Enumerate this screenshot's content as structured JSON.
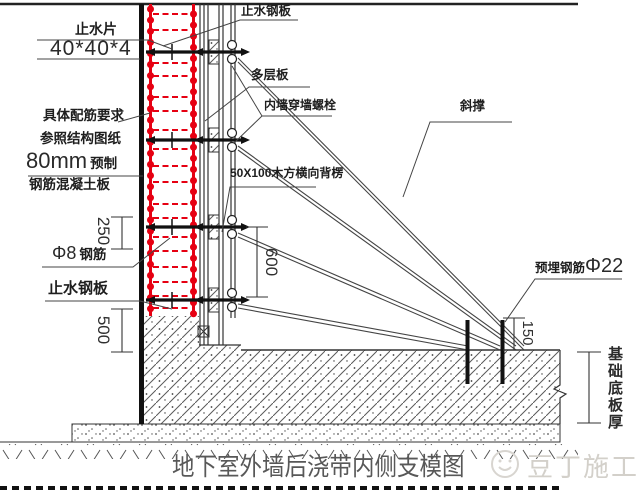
{
  "drawing": {
    "title": "地下室外墙后浇带内侧支模图",
    "watermark": "豆丁施工",
    "labels": {
      "waterstop_strip": "止水片",
      "waterstop_strip_size": "40*40*4",
      "rebar_req_line1": "具体配筋要求",
      "rebar_req_line2": "参照结构图纸",
      "precast_size": "80mm",
      "precast_word": "预制",
      "rc_panel": "钢筋混凝土板",
      "phi8_prefix": "Φ8",
      "phi8_word": "钢筋",
      "waterstop_plate_left": "止水钢板",
      "waterstop_plate_top": "止水钢板",
      "plywood": "多层板",
      "wall_bolt": "内墙穿墙螺栓",
      "waler": "50X100木方横向背楞",
      "brace": "斜撑",
      "embed_prefix": "预埋钢筋",
      "embed_size": "Φ22",
      "slab_thickness": "基础底板厚"
    },
    "dimensions": {
      "d250": "250",
      "d600": "600",
      "d500": "500",
      "d150": "150"
    },
    "colors": {
      "rebar_red": "#e60012",
      "line": "#222222",
      "watermark_gray": "#d3d0ca",
      "title_gray": "#585858"
    }
  }
}
